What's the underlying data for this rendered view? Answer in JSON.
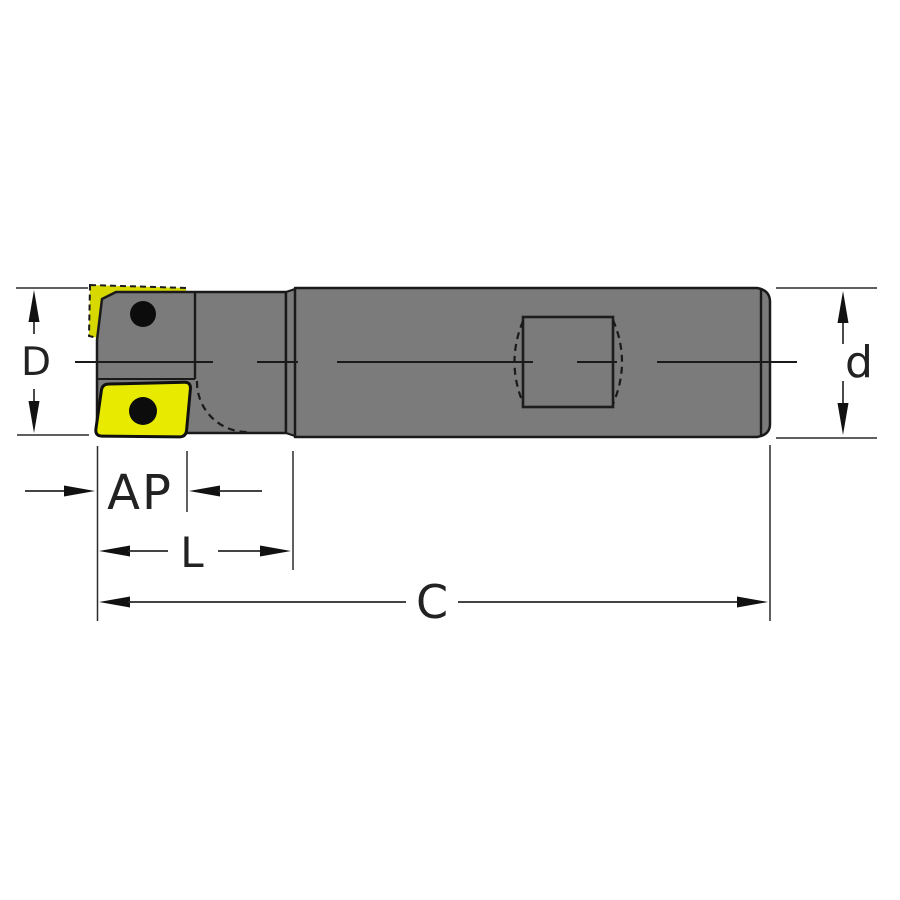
{
  "diagram": {
    "kind": "indexable-end-mill-technical-drawing",
    "labels": {
      "D": "D",
      "d": "d",
      "AP": "AP",
      "L": "L",
      "C": "C"
    },
    "parts": {
      "cutter_head": "cutter head with indexable inserts",
      "shank": "cylindrical shank with weldon flat",
      "insert": "carbide insert"
    }
  },
  "colors": {
    "background": "#ffffff",
    "body_gray": "#7b7b7b",
    "insert_yellow": "#e8eb00",
    "insert_yellow_dark": "#d6d800",
    "hole_black": "#0c0c0c",
    "outline": "#1a1a1a"
  }
}
